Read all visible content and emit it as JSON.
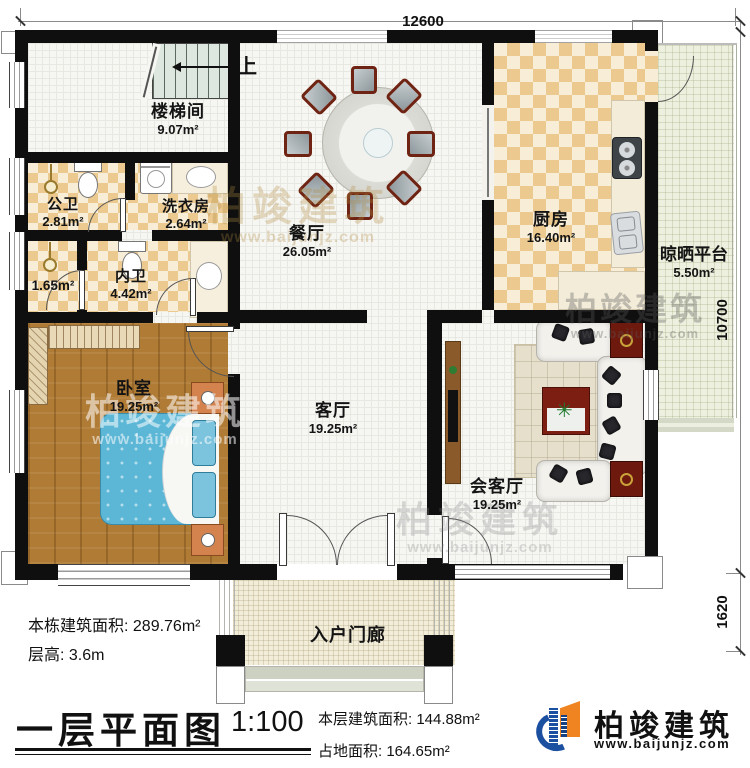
{
  "dims": {
    "top": "12600",
    "right": "10700",
    "right_lower": "1620"
  },
  "stair": {
    "up": "上"
  },
  "rooms": {
    "stairwell": {
      "name": "楼梯间",
      "area": "9.07m²"
    },
    "public_bath": {
      "name": "公卫",
      "area": "2.81m²"
    },
    "laundry": {
      "name": "洗衣房",
      "area": "2.64m²"
    },
    "closet": {
      "name": "",
      "area": "1.65m²"
    },
    "private_bath": {
      "name": "内卫",
      "area": "4.42m²"
    },
    "dining": {
      "name": "餐厅",
      "area": "26.05m²"
    },
    "kitchen": {
      "name": "厨房",
      "area": "16.40m²"
    },
    "platform": {
      "name": "晾晒平台",
      "area": "5.50m²"
    },
    "bedroom": {
      "name": "卧室",
      "area": "19.25m²"
    },
    "living": {
      "name": "客厅",
      "area": "19.25m²"
    },
    "reception": {
      "name": "会客厅",
      "area": "19.25m²"
    },
    "porch": {
      "name": "入户门廊",
      "area": ""
    }
  },
  "info": {
    "building_total": "本栋建筑面积: 289.76m²",
    "floor_height": "层高: 3.6m",
    "title": "一层平面图",
    "scale": "1:100",
    "floor_area": "本层建筑面积: 144.88m²",
    "land_area": "占地面积: 164.65m²"
  },
  "logo": {
    "name": "柏竣建筑",
    "url": "www.baijunjz.com"
  },
  "watermark": {
    "text": "柏竣建筑",
    "url": "www.baijunjz.com"
  },
  "colors": {
    "wall": "#0f0f0f",
    "logo_blue": "#1b4f9f",
    "logo_orange": "#f08420",
    "bed_blue": "#5cb6d6",
    "table_red": "#7c1f12"
  }
}
